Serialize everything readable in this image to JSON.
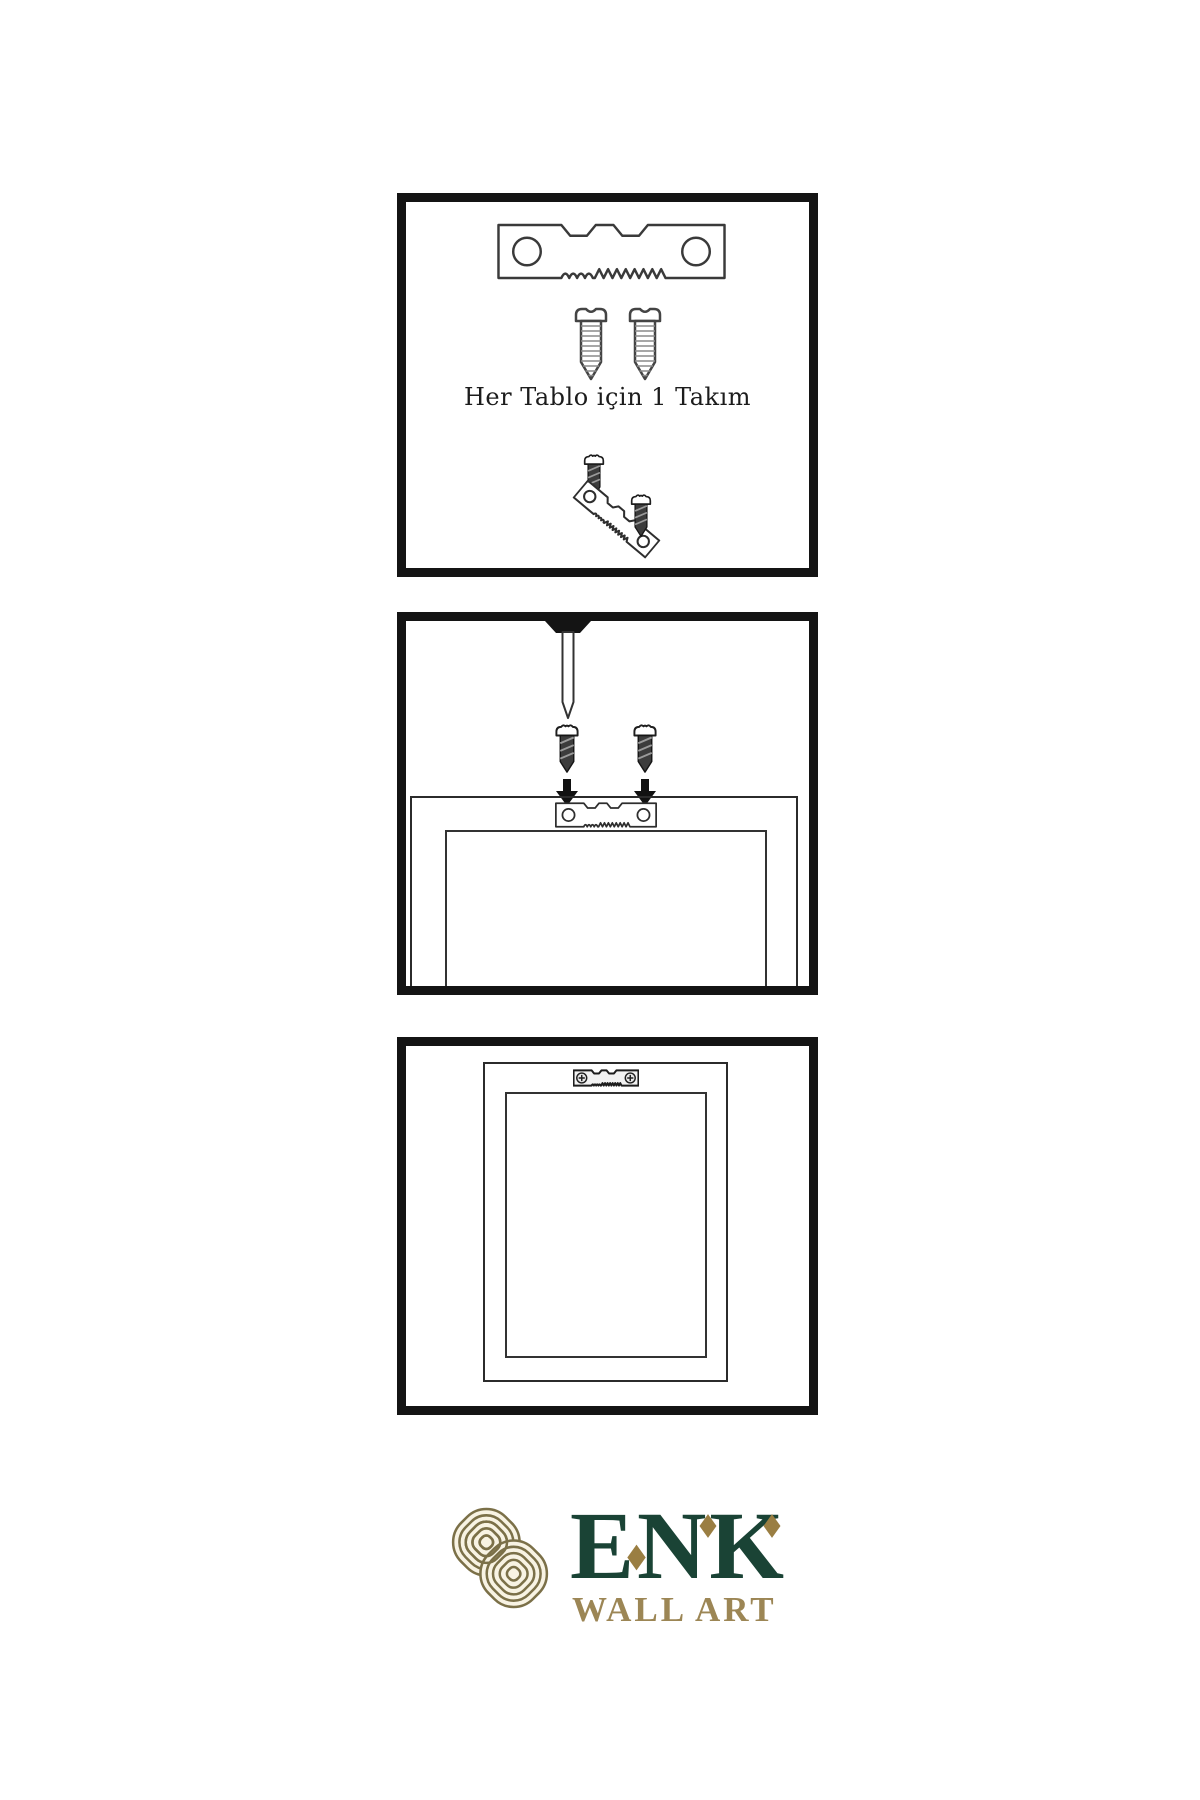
{
  "page": {
    "width_px": 1200,
    "height_px": 1800,
    "background": "#ffffff",
    "ink_color": "#2b2b2b",
    "panel_border_color": "#141414"
  },
  "panels": [
    {
      "name": "hardware-kit",
      "caption": "Her Tablo için 1 Takım",
      "icons": [
        "sawtooth-hanger-icon",
        "screw-icon",
        "screw-icon",
        "dark-screw-icon",
        "tilted-sawtooth-hanger-icon",
        "dark-screw-icon"
      ]
    },
    {
      "name": "wall-nail-and-screws",
      "icons": [
        "nail-icon",
        "dark-screw-icon",
        "down-arrow-icon",
        "dark-screw-icon",
        "down-arrow-icon",
        "frame-back-icon",
        "sawtooth-hanger-icon"
      ]
    },
    {
      "name": "mounted-frame",
      "icons": [
        "frame-back-icon",
        "mounted-sawtooth-hanger-icon",
        "phillips-screw-head-icon",
        "phillips-screw-head-icon"
      ]
    }
  ],
  "logo": {
    "brand": "ENK",
    "subtitle": "WALL ART",
    "icon": "knot-logo-icon",
    "colors": {
      "brand_green": "#1a4335",
      "accent_gold": "#9a7e42",
      "knot_line": "#7b7048",
      "knot_fill": "#f8f3e3"
    }
  }
}
